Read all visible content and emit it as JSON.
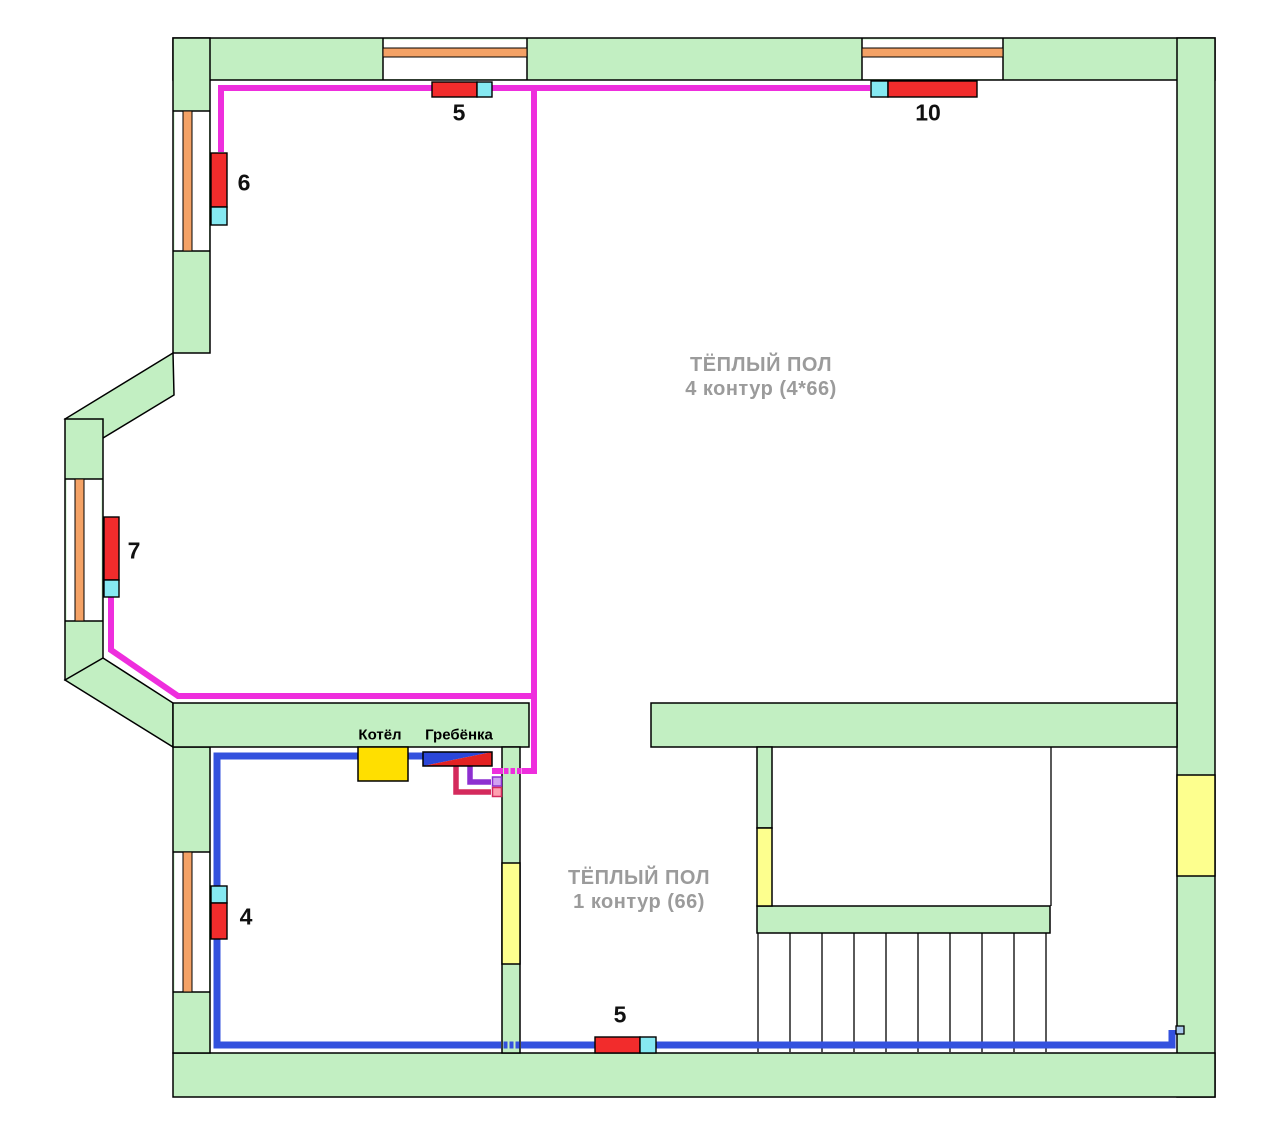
{
  "diagram": {
    "type": "heating-floor-plan",
    "room_labels": [
      {
        "line1": "ТЁПЛЫЙ ПОЛ",
        "line2": "4 контур (4*66)"
      },
      {
        "line1": "ТЁПЛЫЙ ПОЛ",
        "line2": "1 контур (66)"
      }
    ],
    "equipment": {
      "boiler": "Котёл",
      "manifold": "Гребёнка"
    },
    "radiators": [
      {
        "id": "top-left",
        "label": "5"
      },
      {
        "id": "top-right",
        "label": "10"
      },
      {
        "id": "left-upper",
        "label": "6"
      },
      {
        "id": "left-bay",
        "label": "7"
      },
      {
        "id": "left-lower",
        "label": "4"
      },
      {
        "id": "bottom-center",
        "label": "5"
      }
    ],
    "colors": {
      "wall": "#c2efc2",
      "window_glass": "#f4a266",
      "radiator": "#f22c2c",
      "valve": "#86e9f2",
      "pipe_heating_loop": "#ee2edd",
      "pipe_boiler_loop": "#3351de",
      "pipe_return": "#d42a5c",
      "pipe_supply": "#8d2fd0",
      "boiler": "#ffdf00",
      "door": "#fdff8e",
      "label_gray": "#9b9b9b"
    }
  }
}
